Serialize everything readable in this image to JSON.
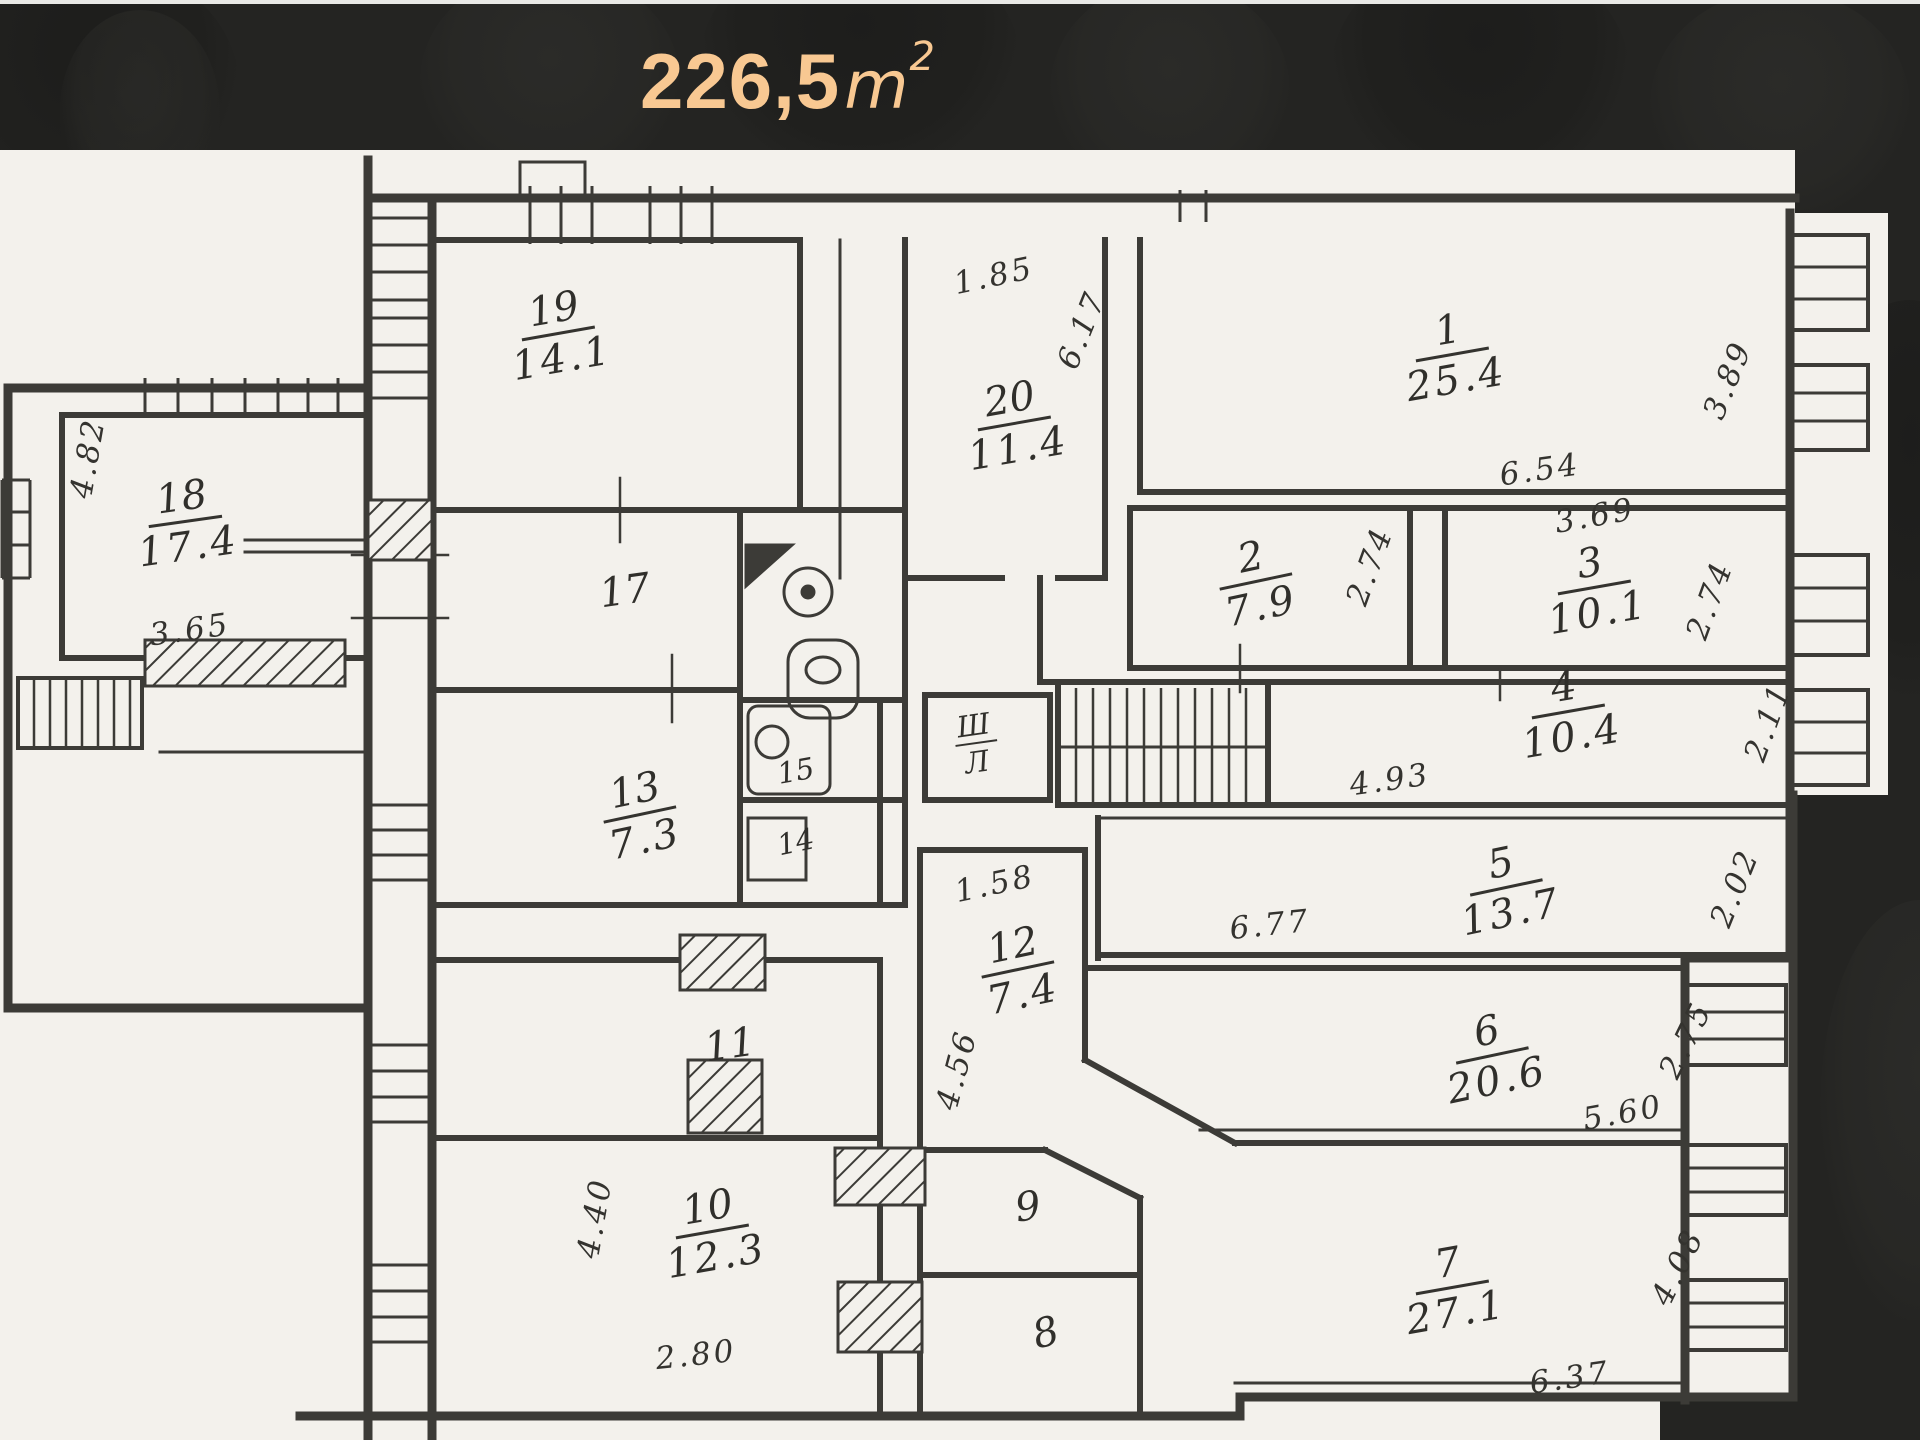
{
  "header": {
    "area_value": "226,5",
    "area_unit": "m",
    "area_sup": "2",
    "title_color": "#f8c892",
    "background_color": "#242422"
  },
  "floorplan": {
    "paper_color": "#f3f1ec",
    "ink_color": "#3c3b37",
    "icons": [
      "window-icon",
      "stairs-icon",
      "toilet-icon",
      "sink-icon",
      "boiler-icon",
      "hatched-wall-icon"
    ],
    "rooms": [
      {
        "number": "18",
        "area": "17.4",
        "x": 185,
        "y": 522,
        "rot": -8
      },
      {
        "number": "19",
        "area": "14.1",
        "x": 558,
        "y": 334,
        "rot": -10
      },
      {
        "number": "17",
        "area": null,
        "x": 625,
        "y": 592,
        "rot": -8
      },
      {
        "number": "13",
        "area": "7.3",
        "x": 640,
        "y": 815,
        "rot": -12
      },
      {
        "number": "15",
        "area": null,
        "x": 796,
        "y": 772,
        "rot": -10,
        "size": "sm"
      },
      {
        "number": "14",
        "area": null,
        "x": 796,
        "y": 843,
        "rot": -12,
        "size": "sm"
      },
      {
        "number": "20",
        "area": "11.4",
        "x": 1014,
        "y": 424,
        "rot": -10
      },
      {
        "number": "Ш",
        "area": "Л",
        "x": 976,
        "y": 744,
        "rot": -8,
        "size": "sm"
      },
      {
        "number": "12",
        "area": "7.4",
        "x": 1018,
        "y": 970,
        "rot": -12
      },
      {
        "number": "11",
        "area": null,
        "x": 730,
        "y": 1046,
        "rot": -8
      },
      {
        "number": "10",
        "area": "12.3",
        "x": 712,
        "y": 1232,
        "rot": -10
      },
      {
        "number": "9",
        "area": null,
        "x": 1028,
        "y": 1208,
        "rot": -8
      },
      {
        "number": "8",
        "area": null,
        "x": 1046,
        "y": 1334,
        "rot": -15
      },
      {
        "number": "1",
        "area": "25.4",
        "x": 1452,
        "y": 355,
        "rot": -10
      },
      {
        "number": "2",
        "area": "7.9",
        "x": 1256,
        "y": 582,
        "rot": -12
      },
      {
        "number": "3",
        "area": "10.1",
        "x": 1594,
        "y": 588,
        "rot": -10
      },
      {
        "number": "4",
        "area": "10.4",
        "x": 1568,
        "y": 712,
        "rot": -10
      },
      {
        "number": "5",
        "area": "13.7",
        "x": 1506,
        "y": 888,
        "rot": -12
      },
      {
        "number": "6",
        "area": "20.6",
        "x": 1492,
        "y": 1056,
        "rot": -12
      },
      {
        "number": "7",
        "area": "27.1",
        "x": 1452,
        "y": 1288,
        "rot": -10
      }
    ],
    "dimensions": [
      {
        "text": "4.82",
        "x": 88,
        "y": 458,
        "rot": -80
      },
      {
        "text": "3.65",
        "x": 190,
        "y": 630,
        "rot": -8
      },
      {
        "text": "1.85",
        "x": 994,
        "y": 276,
        "rot": -12
      },
      {
        "text": "6.17",
        "x": 1082,
        "y": 330,
        "rot": -68
      },
      {
        "text": "3.89",
        "x": 1728,
        "y": 380,
        "rot": -68
      },
      {
        "text": "6.54",
        "x": 1540,
        "y": 470,
        "rot": -8
      },
      {
        "text": "3.69",
        "x": 1595,
        "y": 516,
        "rot": -10
      },
      {
        "text": "2.74",
        "x": 1370,
        "y": 566,
        "rot": -70
      },
      {
        "text": "2.74",
        "x": 1710,
        "y": 600,
        "rot": -70
      },
      {
        "text": "4.93",
        "x": 1390,
        "y": 780,
        "rot": -8
      },
      {
        "text": "2.11",
        "x": 1768,
        "y": 722,
        "rot": -70
      },
      {
        "text": "6.77",
        "x": 1270,
        "y": 925,
        "rot": -6
      },
      {
        "text": "2.02",
        "x": 1735,
        "y": 888,
        "rot": -68
      },
      {
        "text": "2.75",
        "x": 1686,
        "y": 1040,
        "rot": -64
      },
      {
        "text": "5.60",
        "x": 1623,
        "y": 1113,
        "rot": -10
      },
      {
        "text": "4.08",
        "x": 1678,
        "y": 1267,
        "rot": -64
      },
      {
        "text": "6.37",
        "x": 1570,
        "y": 1378,
        "rot": -8
      },
      {
        "text": "1.58",
        "x": 995,
        "y": 884,
        "rot": -12
      },
      {
        "text": "4.56",
        "x": 957,
        "y": 1070,
        "rot": -75
      },
      {
        "text": "4.40",
        "x": 595,
        "y": 1218,
        "rot": -80
      },
      {
        "text": "2.80",
        "x": 696,
        "y": 1355,
        "rot": -6
      }
    ]
  }
}
